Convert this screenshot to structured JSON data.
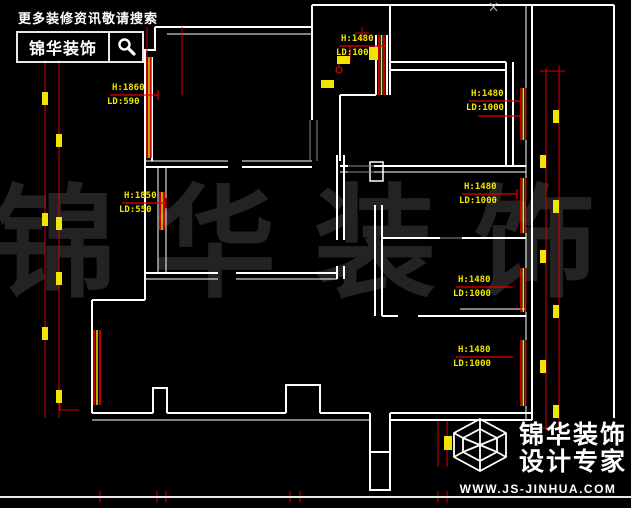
{
  "page": {
    "background": "#000000",
    "type": "cad-floor-plan"
  },
  "header": {
    "tagline": "更多装修资讯敬请搜索",
    "brand": "锦华装饰",
    "search_icon": "magnifier-icon"
  },
  "watermark": {
    "text": "锦华装饰"
  },
  "window_labels": [
    {
      "h": "H:1860",
      "ld": "LD:590"
    },
    {
      "h": "H:1850",
      "ld": "LD:550"
    },
    {
      "h": "H:1480",
      "ld": "LD:1000"
    },
    {
      "h": "H:1480",
      "ld": "LD:1000"
    },
    {
      "h": "H:1480",
      "ld": "LD:1000"
    },
    {
      "h": "H:1480",
      "ld": "LD:1000"
    },
    {
      "h": "H:1480",
      "ld": "LD:1000"
    }
  ],
  "footer_logo": {
    "brand": "锦华装饰",
    "subtitle": "设计专家",
    "url": "WWW.JS-JINHUA.COM",
    "icon": "cube-wireframe-icon"
  },
  "colors": {
    "background": "#000000",
    "walls": "#ffffff",
    "dimension_lines": "#d40000",
    "window_lines": "#ff0000",
    "markers": "#f0e400",
    "label_text": "#f0e400",
    "watermark": "#232323"
  }
}
